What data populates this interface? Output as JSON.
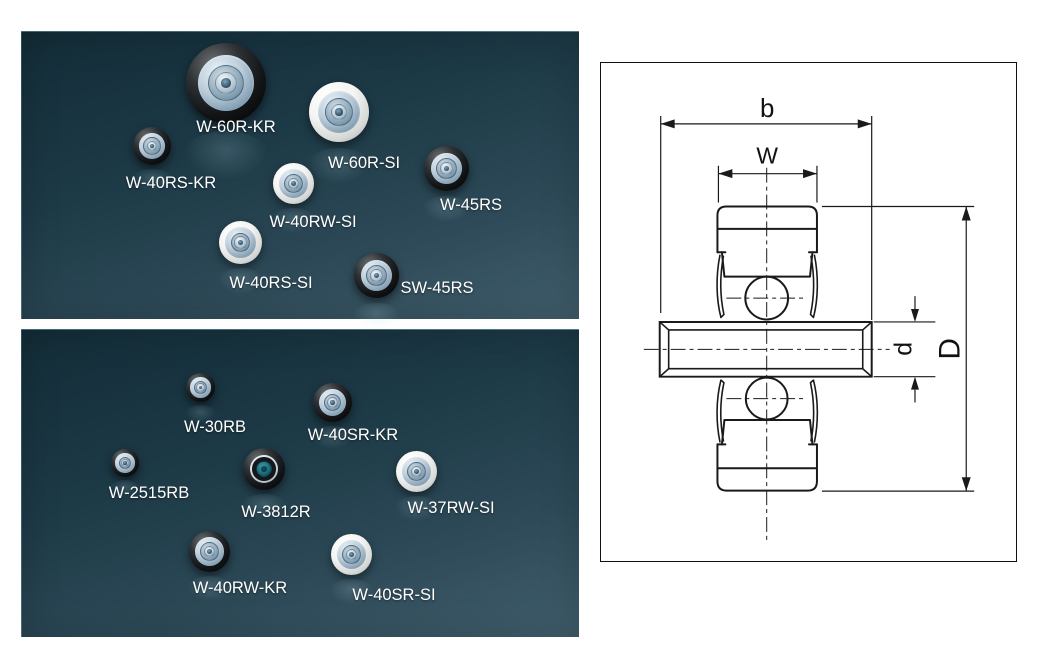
{
  "panels": [
    {
      "items": [
        {
          "label": "W-60R-KR",
          "finish": "black"
        },
        {
          "label": "W-40RS-KR",
          "finish": "black"
        },
        {
          "label": "W-60R-SI",
          "finish": "white"
        },
        {
          "label": "W-40RW-SI",
          "finish": "white"
        },
        {
          "label": "W-45RS",
          "finish": "black"
        },
        {
          "label": "W-40RS-SI",
          "finish": "white"
        },
        {
          "label": "SW-45RS",
          "finish": "black"
        }
      ]
    },
    {
      "items": [
        {
          "label": "W-30RB",
          "finish": "black"
        },
        {
          "label": "W-40SR-KR",
          "finish": "black"
        },
        {
          "label": "W-2515RB",
          "finish": "black"
        },
        {
          "label": "W-3812R",
          "finish": "teal"
        },
        {
          "label": "W-37RW-SI",
          "finish": "white"
        },
        {
          "label": "W-40RW-KR",
          "finish": "black"
        },
        {
          "label": "W-40SR-SI",
          "finish": "white"
        }
      ]
    }
  ],
  "diagram": {
    "dimension_labels": {
      "overall_width": "b",
      "tread_width": "W",
      "shaft_diameter": "d",
      "outer_diameter": "D"
    }
  },
  "colors": {
    "panel_gradient_dark": "#132d38",
    "panel_gradient_light": "#415e6c",
    "label_text": "#ffffff",
    "diagram_line": "#1a1a1a",
    "diagram_background": "#ffffff",
    "teal_hub": "#1d6b79"
  }
}
